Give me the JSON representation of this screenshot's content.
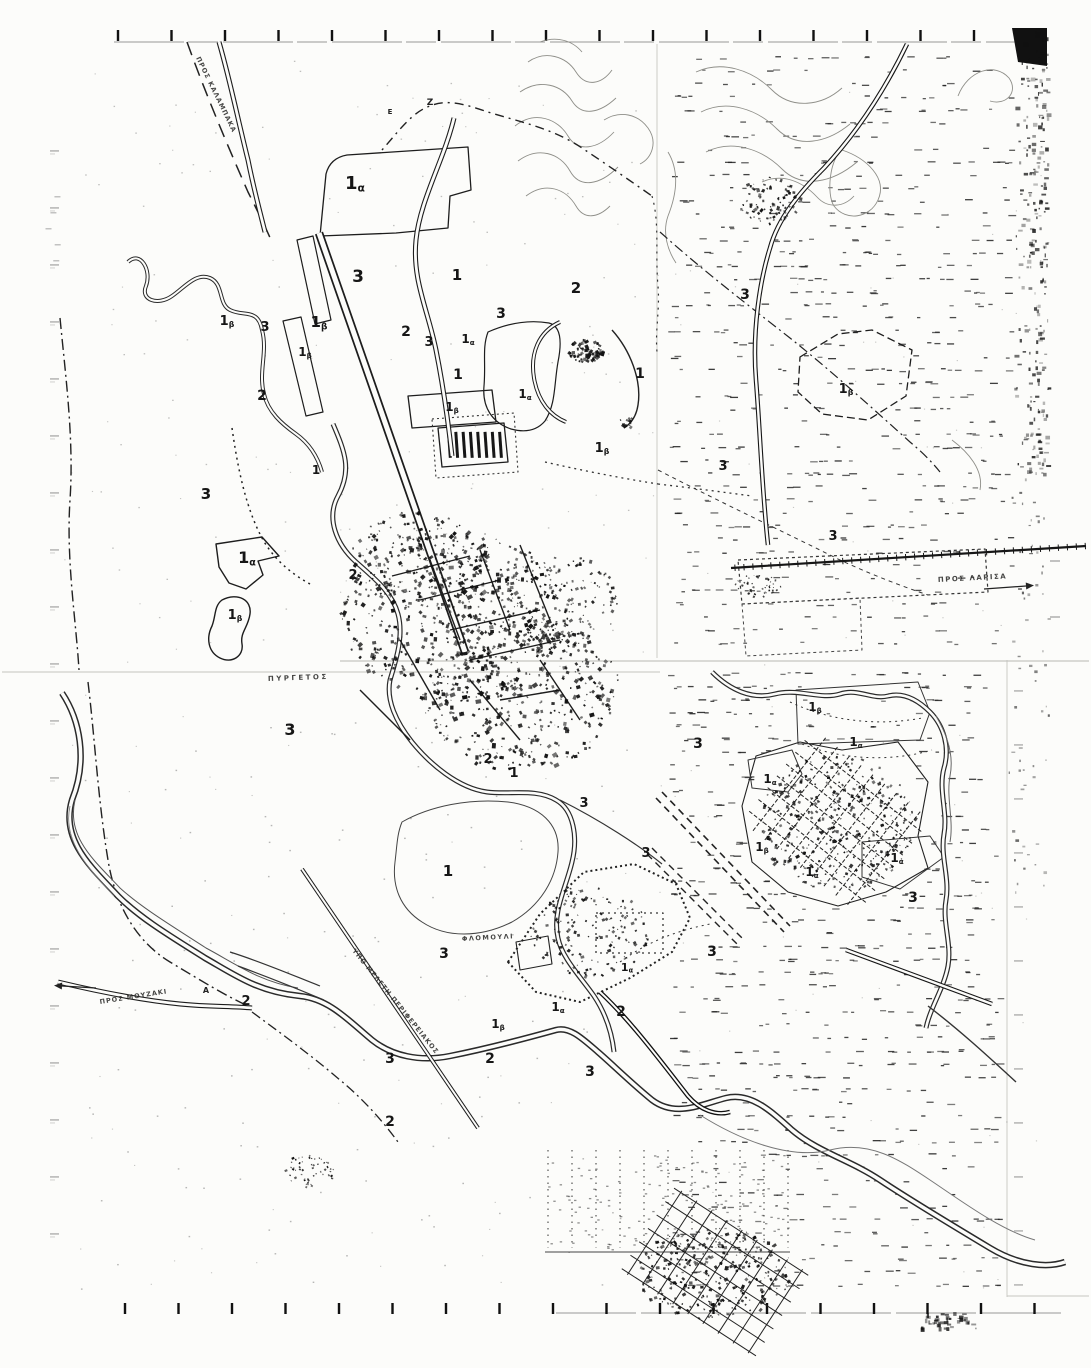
{
  "map": {
    "colors": {
      "paper": "#fcfcfa",
      "ink": "#1a1a1a",
      "contour": "#8e8e88",
      "faint_line": "#9a9a94",
      "seam": "#c6c6c0"
    },
    "frame": {
      "top_ticks": {
        "count": 18,
        "x_start": 118,
        "x_step": 53.5,
        "y": 30,
        "length": 11
      },
      "bottom_ticks": {
        "count": 18,
        "x_start": 125,
        "x_step": 53.5,
        "y": 1303,
        "length": 11
      }
    },
    "zone_labels": [
      {
        "main": "1",
        "sub": "α",
        "x": 355,
        "y": 189,
        "size": 18
      },
      {
        "main": "3",
        "sub": "",
        "x": 358,
        "y": 282,
        "size": 17
      },
      {
        "main": "1",
        "sub": "",
        "x": 457,
        "y": 280,
        "size": 15
      },
      {
        "main": "2",
        "sub": "",
        "x": 576,
        "y": 293,
        "size": 15
      },
      {
        "main": "3",
        "sub": "",
        "x": 501,
        "y": 318,
        "size": 14
      },
      {
        "main": "1",
        "sub": "β",
        "x": 227,
        "y": 325,
        "size": 13
      },
      {
        "main": "3",
        "sub": "",
        "x": 265,
        "y": 331,
        "size": 13
      },
      {
        "main": "1",
        "sub": "β",
        "x": 319,
        "y": 327,
        "size": 15
      },
      {
        "main": "2",
        "sub": "",
        "x": 406,
        "y": 336,
        "size": 14
      },
      {
        "main": "3",
        "sub": "",
        "x": 429,
        "y": 346,
        "size": 13
      },
      {
        "main": "1",
        "sub": "α",
        "x": 468,
        "y": 343,
        "size": 12
      },
      {
        "main": "1",
        "sub": "β",
        "x": 305,
        "y": 356,
        "size": 12
      },
      {
        "main": "1",
        "sub": "",
        "x": 458,
        "y": 379,
        "size": 14
      },
      {
        "main": "1",
        "sub": "α",
        "x": 525,
        "y": 398,
        "size": 12
      },
      {
        "main": "2",
        "sub": "",
        "x": 262,
        "y": 400,
        "size": 14
      },
      {
        "main": "1",
        "sub": "β",
        "x": 452,
        "y": 411,
        "size": 12
      },
      {
        "main": "1",
        "sub": "",
        "x": 640,
        "y": 378,
        "size": 14
      },
      {
        "main": "1",
        "sub": "β",
        "x": 602,
        "y": 452,
        "size": 13
      },
      {
        "main": "1",
        "sub": "",
        "x": 316,
        "y": 474,
        "size": 12
      },
      {
        "main": "3",
        "sub": "",
        "x": 206,
        "y": 499,
        "size": 15
      },
      {
        "main": "1",
        "sub": "α",
        "x": 247,
        "y": 563,
        "size": 16
      },
      {
        "main": "2",
        "sub": "",
        "x": 353,
        "y": 579,
        "size": 13
      },
      {
        "main": "1",
        "sub": "β",
        "x": 235,
        "y": 619,
        "size": 13
      },
      {
        "main": "3",
        "sub": "",
        "x": 745,
        "y": 299,
        "size": 14
      },
      {
        "main": "1",
        "sub": "β",
        "x": 846,
        "y": 393,
        "size": 13
      },
      {
        "main": "3",
        "sub": "",
        "x": 723,
        "y": 470,
        "size": 13
      },
      {
        "main": "3",
        "sub": "",
        "x": 833,
        "y": 540,
        "size": 13
      },
      {
        "main": "3",
        "sub": "",
        "x": 290,
        "y": 735,
        "size": 16
      },
      {
        "main": "2",
        "sub": "",
        "x": 488,
        "y": 763,
        "size": 13
      },
      {
        "main": "1",
        "sub": "",
        "x": 514,
        "y": 777,
        "size": 13
      },
      {
        "main": "3",
        "sub": "",
        "x": 584,
        "y": 807,
        "size": 13
      },
      {
        "main": "3",
        "sub": "",
        "x": 646,
        "y": 857,
        "size": 13
      },
      {
        "main": "1",
        "sub": "",
        "x": 448,
        "y": 876,
        "size": 15
      },
      {
        "main": "3",
        "sub": "",
        "x": 444,
        "y": 958,
        "size": 14
      },
      {
        "main": "1",
        "sub": "β",
        "x": 815,
        "y": 711,
        "size": 12
      },
      {
        "main": "3",
        "sub": "",
        "x": 698,
        "y": 748,
        "size": 14
      },
      {
        "main": "1",
        "sub": "α",
        "x": 856,
        "y": 746,
        "size": 12
      },
      {
        "main": "1",
        "sub": "α",
        "x": 770,
        "y": 783,
        "size": 12
      },
      {
        "main": "1",
        "sub": "β",
        "x": 762,
        "y": 851,
        "size": 12
      },
      {
        "main": "1",
        "sub": "α",
        "x": 812,
        "y": 876,
        "size": 12
      },
      {
        "main": "1",
        "sub": "α",
        "x": 897,
        "y": 862,
        "size": 12
      },
      {
        "main": "3",
        "sub": "",
        "x": 913,
        "y": 902,
        "size": 14
      },
      {
        "main": "1",
        "sub": "α",
        "x": 627,
        "y": 971,
        "size": 11
      },
      {
        "main": "3",
        "sub": "",
        "x": 712,
        "y": 956,
        "size": 14
      },
      {
        "main": "1",
        "sub": "β",
        "x": 498,
        "y": 1028,
        "size": 12
      },
      {
        "main": "1",
        "sub": "α",
        "x": 558,
        "y": 1011,
        "size": 12
      },
      {
        "main": "2",
        "sub": "",
        "x": 621,
        "y": 1016,
        "size": 14
      },
      {
        "main": "2",
        "sub": "",
        "x": 490,
        "y": 1063,
        "size": 14
      },
      {
        "main": "3",
        "sub": "",
        "x": 590,
        "y": 1076,
        "size": 14
      },
      {
        "main": "3",
        "sub": "",
        "x": 390,
        "y": 1063,
        "size": 14
      },
      {
        "main": "2",
        "sub": "",
        "x": 390,
        "y": 1126,
        "size": 14
      },
      {
        "main": "2",
        "sub": "",
        "x": 246,
        "y": 1005,
        "size": 13
      }
    ],
    "place_labels": [
      {
        "text": "ΠΡΟΣ ΚΑΛΑΜΠΑΚΑ",
        "x": 196,
        "y": 58,
        "rotate": 64,
        "size": 6.5,
        "spacing": 1
      },
      {
        "text": "ΠΥΡΓΕΤΟΣ",
        "x": 268,
        "y": 681,
        "rotate": -2,
        "size": 7,
        "spacing": 2.5
      },
      {
        "text": "ΦΛΟΜΟΥΛΙ",
        "x": 462,
        "y": 941,
        "rotate": -3,
        "size": 6.5,
        "spacing": 1.5
      },
      {
        "text": "ΥΠΟ ΜΕΛΕΤΗ ΠΕΡΙΦΕΡΕΙΑΚΟΣ",
        "x": 352,
        "y": 951,
        "rotate": 51,
        "size": 6.5,
        "spacing": 1
      },
      {
        "text": "ΠΡΟΣ ΜΟΥΖΑΚΙ",
        "x": 100,
        "y": 1004,
        "rotate": -9,
        "size": 6.5,
        "spacing": 1
      },
      {
        "text": "ΠΡΟΣ ΛΑΡΙΣΑ",
        "x": 938,
        "y": 582,
        "rotate": -3,
        "size": 7,
        "spacing": 1.5
      }
    ],
    "point_labels": [
      {
        "text": "Z",
        "x": 430,
        "y": 105,
        "size": 9
      },
      {
        "text": "Ε",
        "x": 390,
        "y": 114,
        "size": 7
      },
      {
        "text": "Α",
        "x": 206,
        "y": 993,
        "size": 8
      }
    ],
    "arrows": [
      {
        "name": "to-larisa-arrow",
        "x1": 984,
        "y1": 589,
        "x2": 1026,
        "y2": 586
      },
      {
        "name": "to-mouzaki-arrow",
        "x1": 96,
        "y1": 988,
        "x2": 62,
        "y2": 986
      }
    ]
  }
}
